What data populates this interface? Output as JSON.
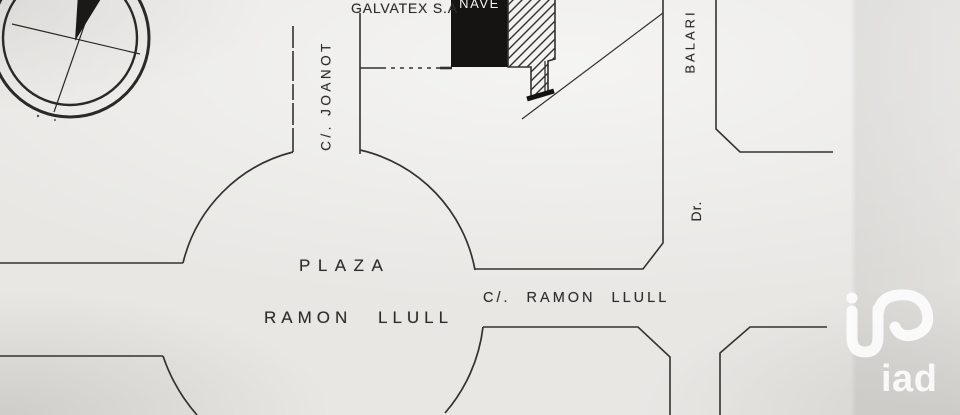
{
  "page": {
    "type": "site-location-plan-photo",
    "paper_color": "#e8e7e4",
    "ink_color": "#34322f"
  },
  "map": {
    "labels": {
      "galvatex": "GALVATEX S.A",
      "nave": "NAVE",
      "joanot": "C/. JOANOT",
      "balari": "BALARI",
      "dr": "Dr.",
      "plaza_line1": "PLAZA",
      "plaza_line2": "RAMON LLULL",
      "ramon_llull_street": "C/. RAMON LLULL"
    },
    "features": {
      "compass": "compass-rose",
      "building": "nave-building-solid-black",
      "hatched_area": "hatched-lot",
      "roundabout": "plaza-ramon-llull-circle"
    },
    "colors": {
      "building_fill": "#151412",
      "nave_text": "#f4f3f0",
      "label_ink": "#2f2d2b"
    }
  },
  "watermark": {
    "brand": "iad",
    "color": "#ffffff"
  }
}
